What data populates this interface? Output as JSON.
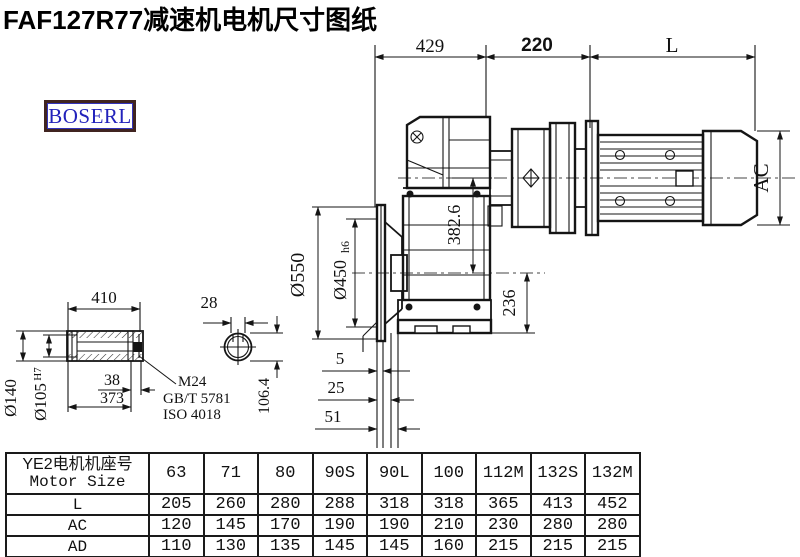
{
  "page": {
    "title": "FAF127R77减速机电机尺寸图纸",
    "brand": "BOSERL"
  },
  "drawing": {
    "dims": {
      "top_left": "429",
      "top_mid": "220",
      "top_right": "L",
      "flange_od": "Ø550",
      "spigot": "Ø450",
      "spigot_tol": "h6",
      "axis_to_output": "382.6",
      "output_to_base": "236",
      "motor_height": "AC",
      "offset_a": "5",
      "offset_b": "25",
      "offset_c": "51",
      "hub_len": "410",
      "key_len": "38",
      "bore_len": "373",
      "hub_od": "Ø140",
      "bore": "Ø105",
      "bore_tol": "H7",
      "key_w": "28",
      "key_depth": "106.4",
      "thread": "M24",
      "std1": "GB/T 5781",
      "std2": "ISO 4018"
    }
  },
  "table": {
    "header": {
      "line1": "YE2电机机座号",
      "line2": "Motor Size"
    },
    "columns": [
      "63",
      "71",
      "80",
      "90S",
      "90L",
      "100",
      "112M",
      "132S",
      "132M"
    ],
    "rows": [
      {
        "label": "L",
        "values": [
          "205",
          "260",
          "280",
          "288",
          "318",
          "318",
          "365",
          "413",
          "452"
        ]
      },
      {
        "label": "AC",
        "values": [
          "120",
          "145",
          "170",
          "190",
          "190",
          "210",
          "230",
          "280",
          "280"
        ]
      },
      {
        "label": "AD",
        "values": [
          "110",
          "130",
          "135",
          "145",
          "145",
          "160",
          "215",
          "215",
          "215"
        ]
      }
    ]
  }
}
